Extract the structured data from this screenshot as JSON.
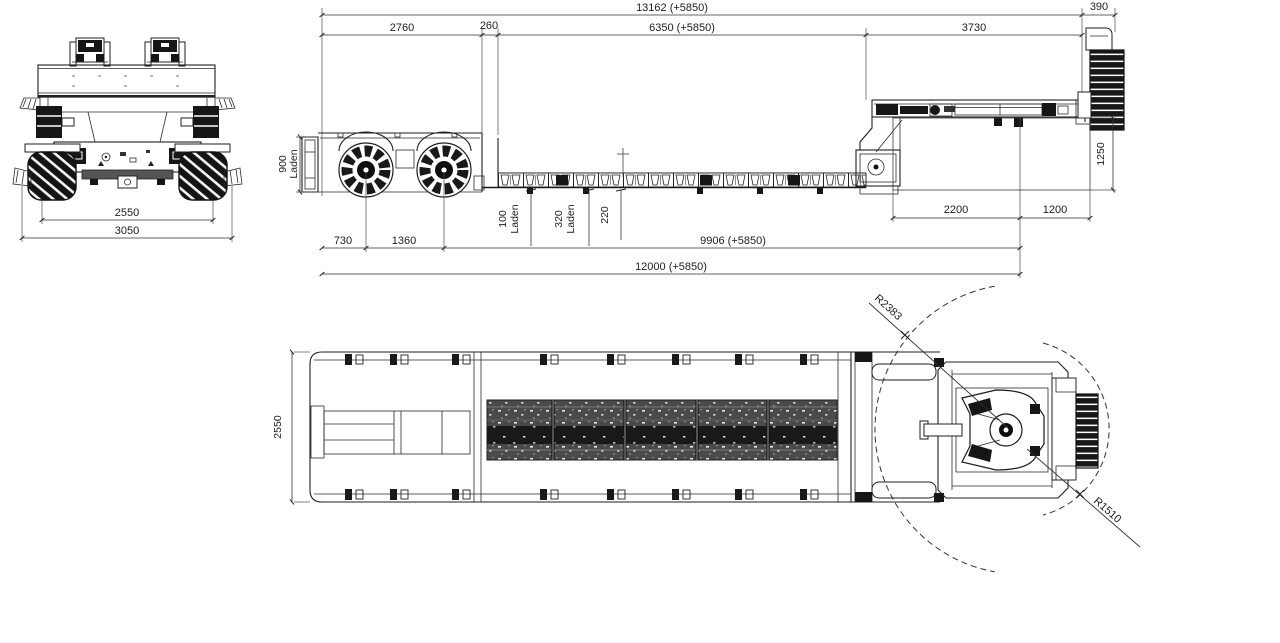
{
  "rear_view": {
    "track_width": "2550",
    "overall_width": "3050"
  },
  "side_view": {
    "overall_length": "13162 (+5850)",
    "spare_overhang": "390",
    "rear_module_length": "2760",
    "step_gap": "260",
    "well_length": "6350 (+5850)",
    "gooseneck_length": "3730",
    "rear_deck_height": "900",
    "laden_note": "Laden",
    "well_deck_height": "100",
    "mid_height": "320",
    "frame_depth": "220",
    "rear_overhang": "730",
    "axle_spacing": "1360",
    "axle_to_kingpin": "9906 (+5850)",
    "rear_to_kingpin": "12000 (+5850)",
    "clearance_box_length": "2200",
    "kingpin_to_front": "1200",
    "gooseneck_clearance_height": "1250"
  },
  "top_view": {
    "deck_width": "2550",
    "rear_swing_radius": "R2383",
    "front_swing_radius": "R1510"
  }
}
